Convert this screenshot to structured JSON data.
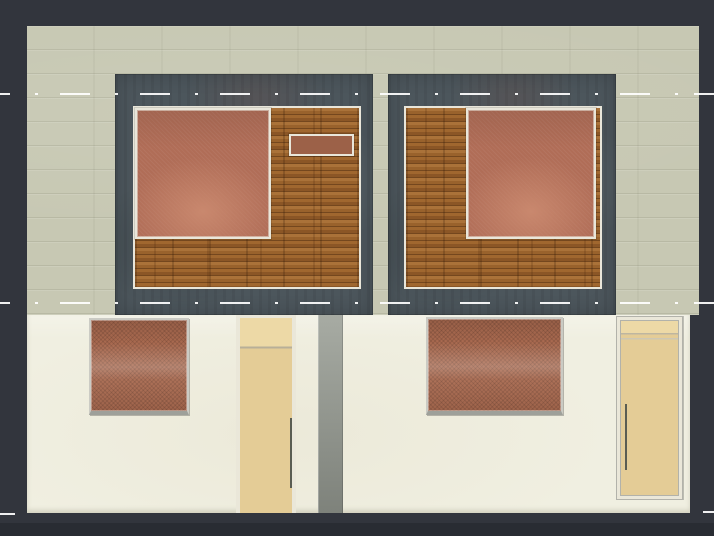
{
  "viewport": {
    "type": "cad-render-elevation",
    "description": "Rendered front elevation of a two-unit house on a dark CAD viewport background"
  },
  "colors": {
    "bg": "#32353d",
    "beige_wall": "#c7c8b3",
    "cream_wall": "#f0efe1",
    "panel_gray": "#4c565c",
    "wood_base": "#99622d",
    "frame_white": "#e9e6da",
    "frame_gray": "#cbcbc4",
    "sill_gray": "#9ea09a",
    "terracotta": "#b06d57",
    "terracotta_light": "#c9886e",
    "terracotta_dark": "#9c6148",
    "hatch_brown": "#a8694f",
    "door_tan": "#e4cc96",
    "door_tan_light": "#edd9a6",
    "door_frame": "#eae7d9",
    "door_frame_line": "#b2b2aa",
    "gray_strip_top": "#a7aba3",
    "gray_strip_bottom": "#7e827b",
    "handle": "#5a5d52",
    "centerline": "#ffffff"
  },
  "entities": {
    "upper_wall": "stone-clad upper facade band",
    "lower_wall": "plaster ground-floor facade",
    "panel_left": "dark slate window panel with wood infill, terracotta glazing and transom slot",
    "panel_right": "dark slate window panel with wood infill and terracotta glazing (mirrored)",
    "lower_window_left": "hatched terracotta window",
    "lower_window_right": "hatched terracotta window (wide)",
    "door_left": "tan entry door with vertical pull handle",
    "door_right": "tan entry door with frame and vertical pull handle",
    "recessed_pier": "gray recessed wall strip between units"
  },
  "centerlines": {
    "pattern": "long-dash dot (CAD center linetype)",
    "y_positions": [
      93,
      302,
      513
    ],
    "ground_line_visible_only_outside_walls": true
  }
}
